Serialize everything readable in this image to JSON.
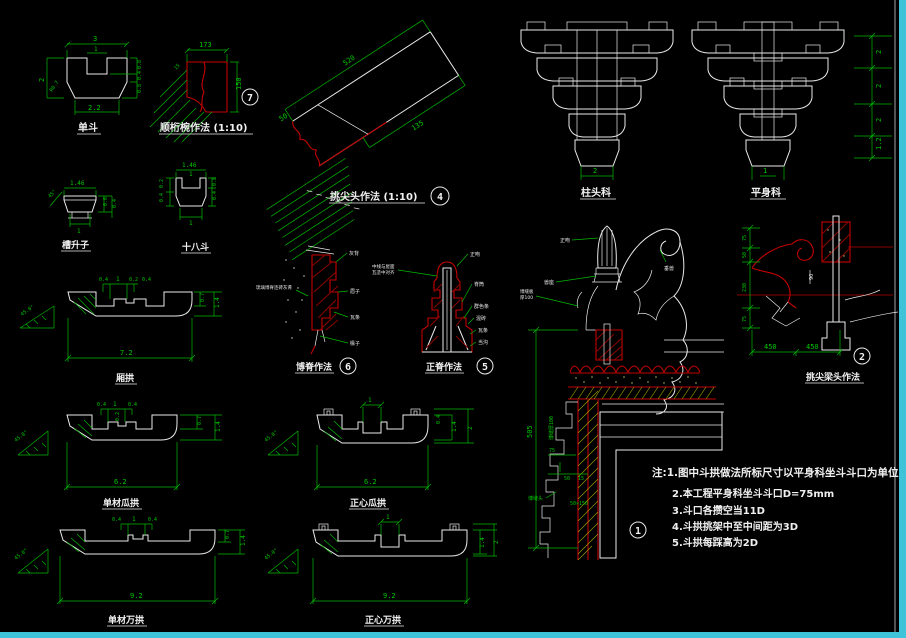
{
  "colors": {
    "background": "#000000",
    "line_white": "#eaeaea",
    "dim_green": "#00c800",
    "detail_red": "#c40000",
    "hatch_yellow": "#a8a800",
    "frame_cyan": "#3fc3d8"
  },
  "dandou": {
    "label": "单斗",
    "t": "3",
    "n": "1",
    "b": "2.2",
    "l": "2",
    "r": "R0.7",
    "r1": "0.8",
    "r2": "0.4",
    "r3": "0.8"
  },
  "hengwan": {
    "label": "顺桁椀作法 (1:10)",
    "t": "173",
    "r": "150",
    "l": "15",
    "circ": "7"
  },
  "tiaojiantou": {
    "label": "挑尖头作法 (1:10)",
    "len": "520",
    "h": "50",
    "b": "135",
    "circ": "4"
  },
  "zhutouke": {
    "label": "柱头科",
    "b": "2"
  },
  "pingshenke": {
    "label": "平身科",
    "b": "1",
    "s1": "2",
    "s2": "2",
    "s3": "2",
    "s4": "1.2"
  },
  "caoshengzi": {
    "label": "槽升子",
    "t": "1.46",
    "b": "1",
    "r1": "0.6",
    "r2": "0.4",
    "a": "45°"
  },
  "shibadou": {
    "label": "十八斗",
    "t": "1.46",
    "n": "1",
    "b": "1",
    "r1": "0.8",
    "r2": "0.4",
    "l1": "0.2",
    "l2": "0.4"
  },
  "xianggong": {
    "label": "厢拱",
    "t1": "0.4",
    "t2": "1",
    "t3": "0.4",
    "m": "0.2",
    "b": "7.2",
    "r1": "0.7",
    "r2": "1.4",
    "a": "45.0°"
  },
  "boji": {
    "label": "博脊作法",
    "circ": "6",
    "ll": "琉璃博脊连砖灰背",
    "l1": "灰背",
    "l2": "眉子",
    "l3": "瓦条",
    "l4": "椽子"
  },
  "zhengji": {
    "label": "正脊作法",
    "circ": "5",
    "t": "正吻",
    "r1": "脊筒",
    "r2": "群色条",
    "r3": "混砖",
    "r4": "瓦条",
    "r5": "当沟",
    "ll1": "中线与屋面",
    "ll2": "瓦垄中对齐"
  },
  "section": {
    "v": "505",
    "d1": "75",
    "d2": "50",
    "d3": "15",
    "d4": "50×150",
    "rot": "博缝厚100",
    "w1": "正吻",
    "w2": "垂兽",
    "w3": "兽座",
    "w4": "博缝板",
    "w5": "厚100",
    "g1": "博缝头",
    "circ": "1"
  },
  "tiaojianliang": {
    "label": "挑尖梁头作法",
    "circ": "2",
    "l1": "75",
    "l2": "50",
    "l3": "230",
    "l4": "75",
    "m": "90",
    "b1": "450",
    "b2": "450"
  },
  "dcgg": {
    "label": "单材瓜拱",
    "t1": "0.4",
    "t2": "1",
    "t3": "0.4",
    "m": "0.2",
    "b": "6.2",
    "r1": "0.7",
    "r2": "1.4",
    "a": "45.0°"
  },
  "zxgg": {
    "label": "正心瓜拱",
    "t": "1",
    "b": "6.2",
    "r1": "1.4",
    "r2": "2",
    "r3": "0.4",
    "a": "45.0°"
  },
  "dcwg": {
    "label": "单材万拱",
    "t1": "0.4",
    "t2": "1",
    "t3": "0.4",
    "b": "9.2",
    "r1": "0.7",
    "r2": "1.4",
    "a": "45.0°"
  },
  "zxwg": {
    "label": "正心万拱",
    "t": "1",
    "b": "9.2",
    "r1": "1.4",
    "r2": "2",
    "a": "45.0°"
  },
  "notes": {
    "n1": "注:1.图中斗拱做法所标尺寸以平身科坐斗斗口为单位",
    "n2": "2.本工程平身科坐斗斗口D=75mm",
    "n3": "3.斗口各攒空当11D",
    "n4": "4.斗拱挑架中至中间距为3D",
    "n5": "5.斗拱每踩高为2D"
  }
}
